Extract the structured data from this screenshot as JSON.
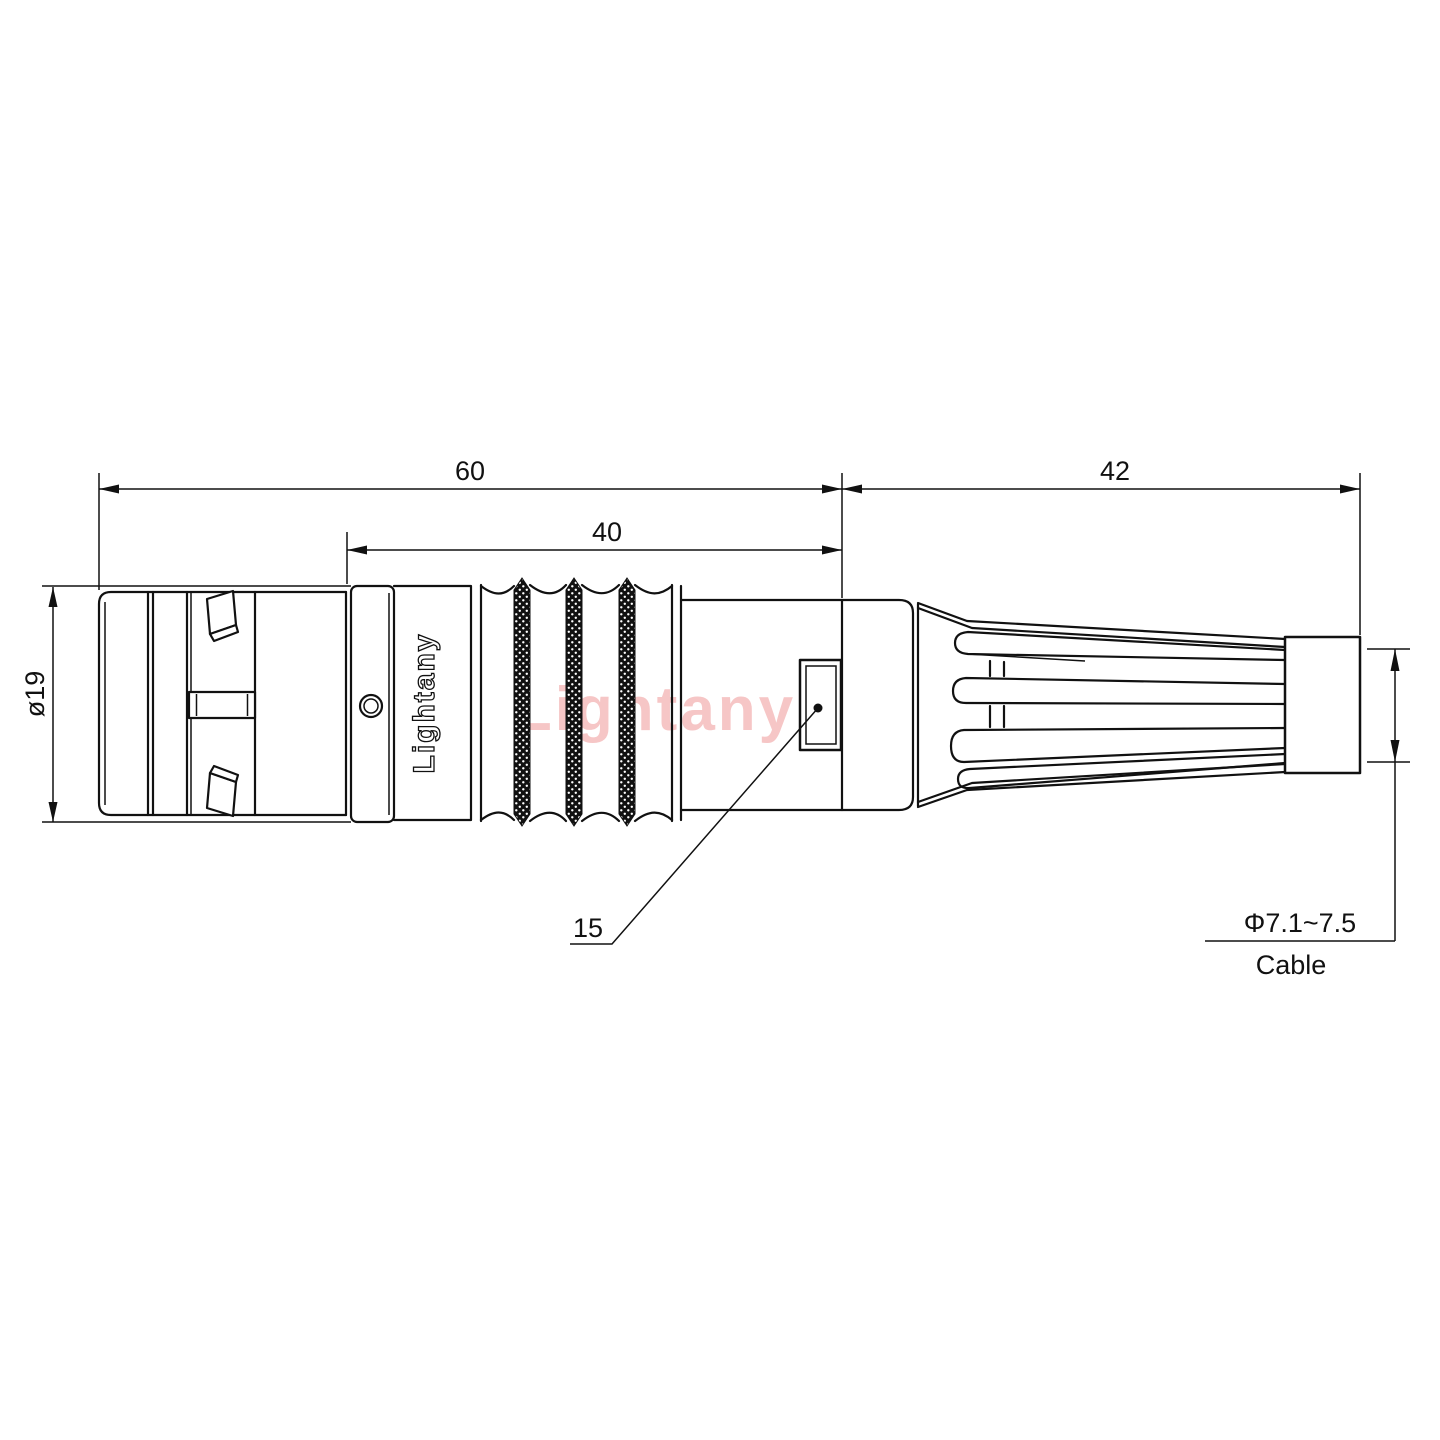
{
  "drawing": {
    "type": "connector-outline-technical-drawing",
    "brand": {
      "body_label": "Lightany",
      "watermark": "Lightany"
    },
    "dimensions": {
      "overall_length": "60",
      "front_section_length": "40",
      "boot_length": "42",
      "outer_diameter": "ø19",
      "latch_callout": "15",
      "cable_diameter_range": "Φ7.1~7.5",
      "cable_label": "Cable"
    },
    "colors": {
      "line": "#111111",
      "background": "#ffffff",
      "watermark": "#f6c6c6"
    }
  }
}
